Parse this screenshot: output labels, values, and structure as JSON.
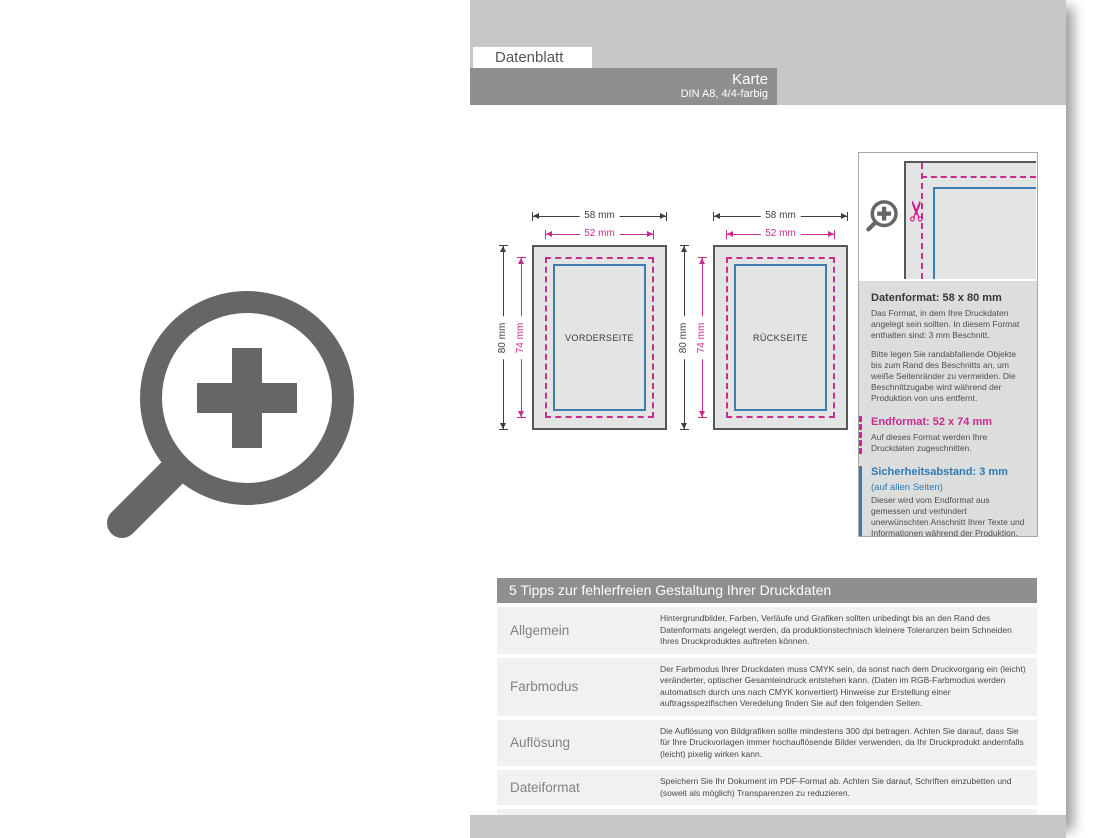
{
  "colors": {
    "magenta": "#c82c8c",
    "blue": "#3d7cae",
    "band_gray": "#c7c7c7",
    "bar_gray": "#8e8f8f",
    "panel_bg": "#dcdddd",
    "row_bg": "#f1f1f1",
    "icon_gray": "#666667"
  },
  "header": {
    "tab_label": "Datenblatt",
    "title": "Karte",
    "subtitle": "DIN A8, 4/4-farbig"
  },
  "diagrams": [
    {
      "label": "VORDERSEITE",
      "outer_width": "58 mm",
      "inner_width": "52 mm",
      "outer_height": "80 mm",
      "inner_height": "74 mm"
    },
    {
      "label": "RÜCKSEITE",
      "outer_width": "58 mm",
      "inner_width": "52 mm",
      "outer_height": "80 mm",
      "inner_height": "74 mm"
    }
  ],
  "icons": {
    "zoom_plus": "zoom-plus-icon",
    "scissors_glyph": "✂"
  },
  "info_panel": {
    "sections": [
      {
        "title": "Datenformat: 58 x 80 mm",
        "paragraphs": [
          "Das Format, in dem Ihre Druckdaten angelegt sein sollten. In diesem Format enthalten sind: 3 mm Beschnitt.",
          "Bitte legen Sie randabfallende Objekte bis zum Rand des Beschnitts an, um weiße Seitenränder zu vermeiden. Die Beschnittzugabe wird während der Produktion von uns entfernt."
        ]
      },
      {
        "title": "Endformat: 52 x 74 mm",
        "paragraphs": [
          "Auf dieses Format werden Ihre Druckdaten zugeschnitten."
        ]
      },
      {
        "title": "Sicherheitsabstand: 3 mm",
        "subtitle": "(auf allen Seiten)",
        "paragraphs": [
          "Dieser wird vom Endformat aus gemessen und verhindert unerwünschten Anschnitt Ihrer Texte und Informationen während der Produktion."
        ]
      }
    ]
  },
  "tips": {
    "title": "5 Tipps zur fehlerfreien Gestaltung Ihrer Druckdaten",
    "rows": [
      {
        "label": "Allgemein",
        "text": "Hintergrundbilder, Farben, Verläufe und Grafiken sollten unbedingt bis an den Rand des Datenformats angelegt werden, da produktionstechnisch kleinere Toleranzen beim Schneiden Ihres Druckproduktes auftreten können."
      },
      {
        "label": "Farbmodus",
        "text": "Der Farbmodus Ihrer Druckdaten muss CMYK sein, da sonst nach dem Druckvorgang ein (leicht) veränderter, optischer Gesamteindruck entstehen kann. (Daten im RGB-Farbmodus werden automatisch durch uns nach CMYK konvertiert) Hinweise zur Erstellung einer auftragsspezifischen Veredelung finden Sie auf den folgenden Seiten."
      },
      {
        "label": "Auflösung",
        "text": "Die Auflösung von Bildgrafiken sollte mindestens 300 dpi betragen. Achten Sie darauf, dass Sie für Ihre Druckvorlagen immer hochauflösende Bilder verwenden, da Ihr Druckprodukt andernfalls (leicht) pixelig wirken kann."
      },
      {
        "label": "Dateiformat",
        "text": "Speichern Sie Ihr Dokument im PDF-Format ab. Achten Sie darauf, Schriften einzubetten und (soweit als möglich) Transparenzen zu reduzieren."
      },
      {
        "label": "Seiten(-reihenfolge)",
        "text": "Senden Sie mehrseitige Dokumente chronologisch in korrekter Reihenfolge als eine einzige PDF-Datei oder benennen Sie Einzeldokumente entsprechend mit fortlaufenden Seitennummern."
      }
    ]
  }
}
